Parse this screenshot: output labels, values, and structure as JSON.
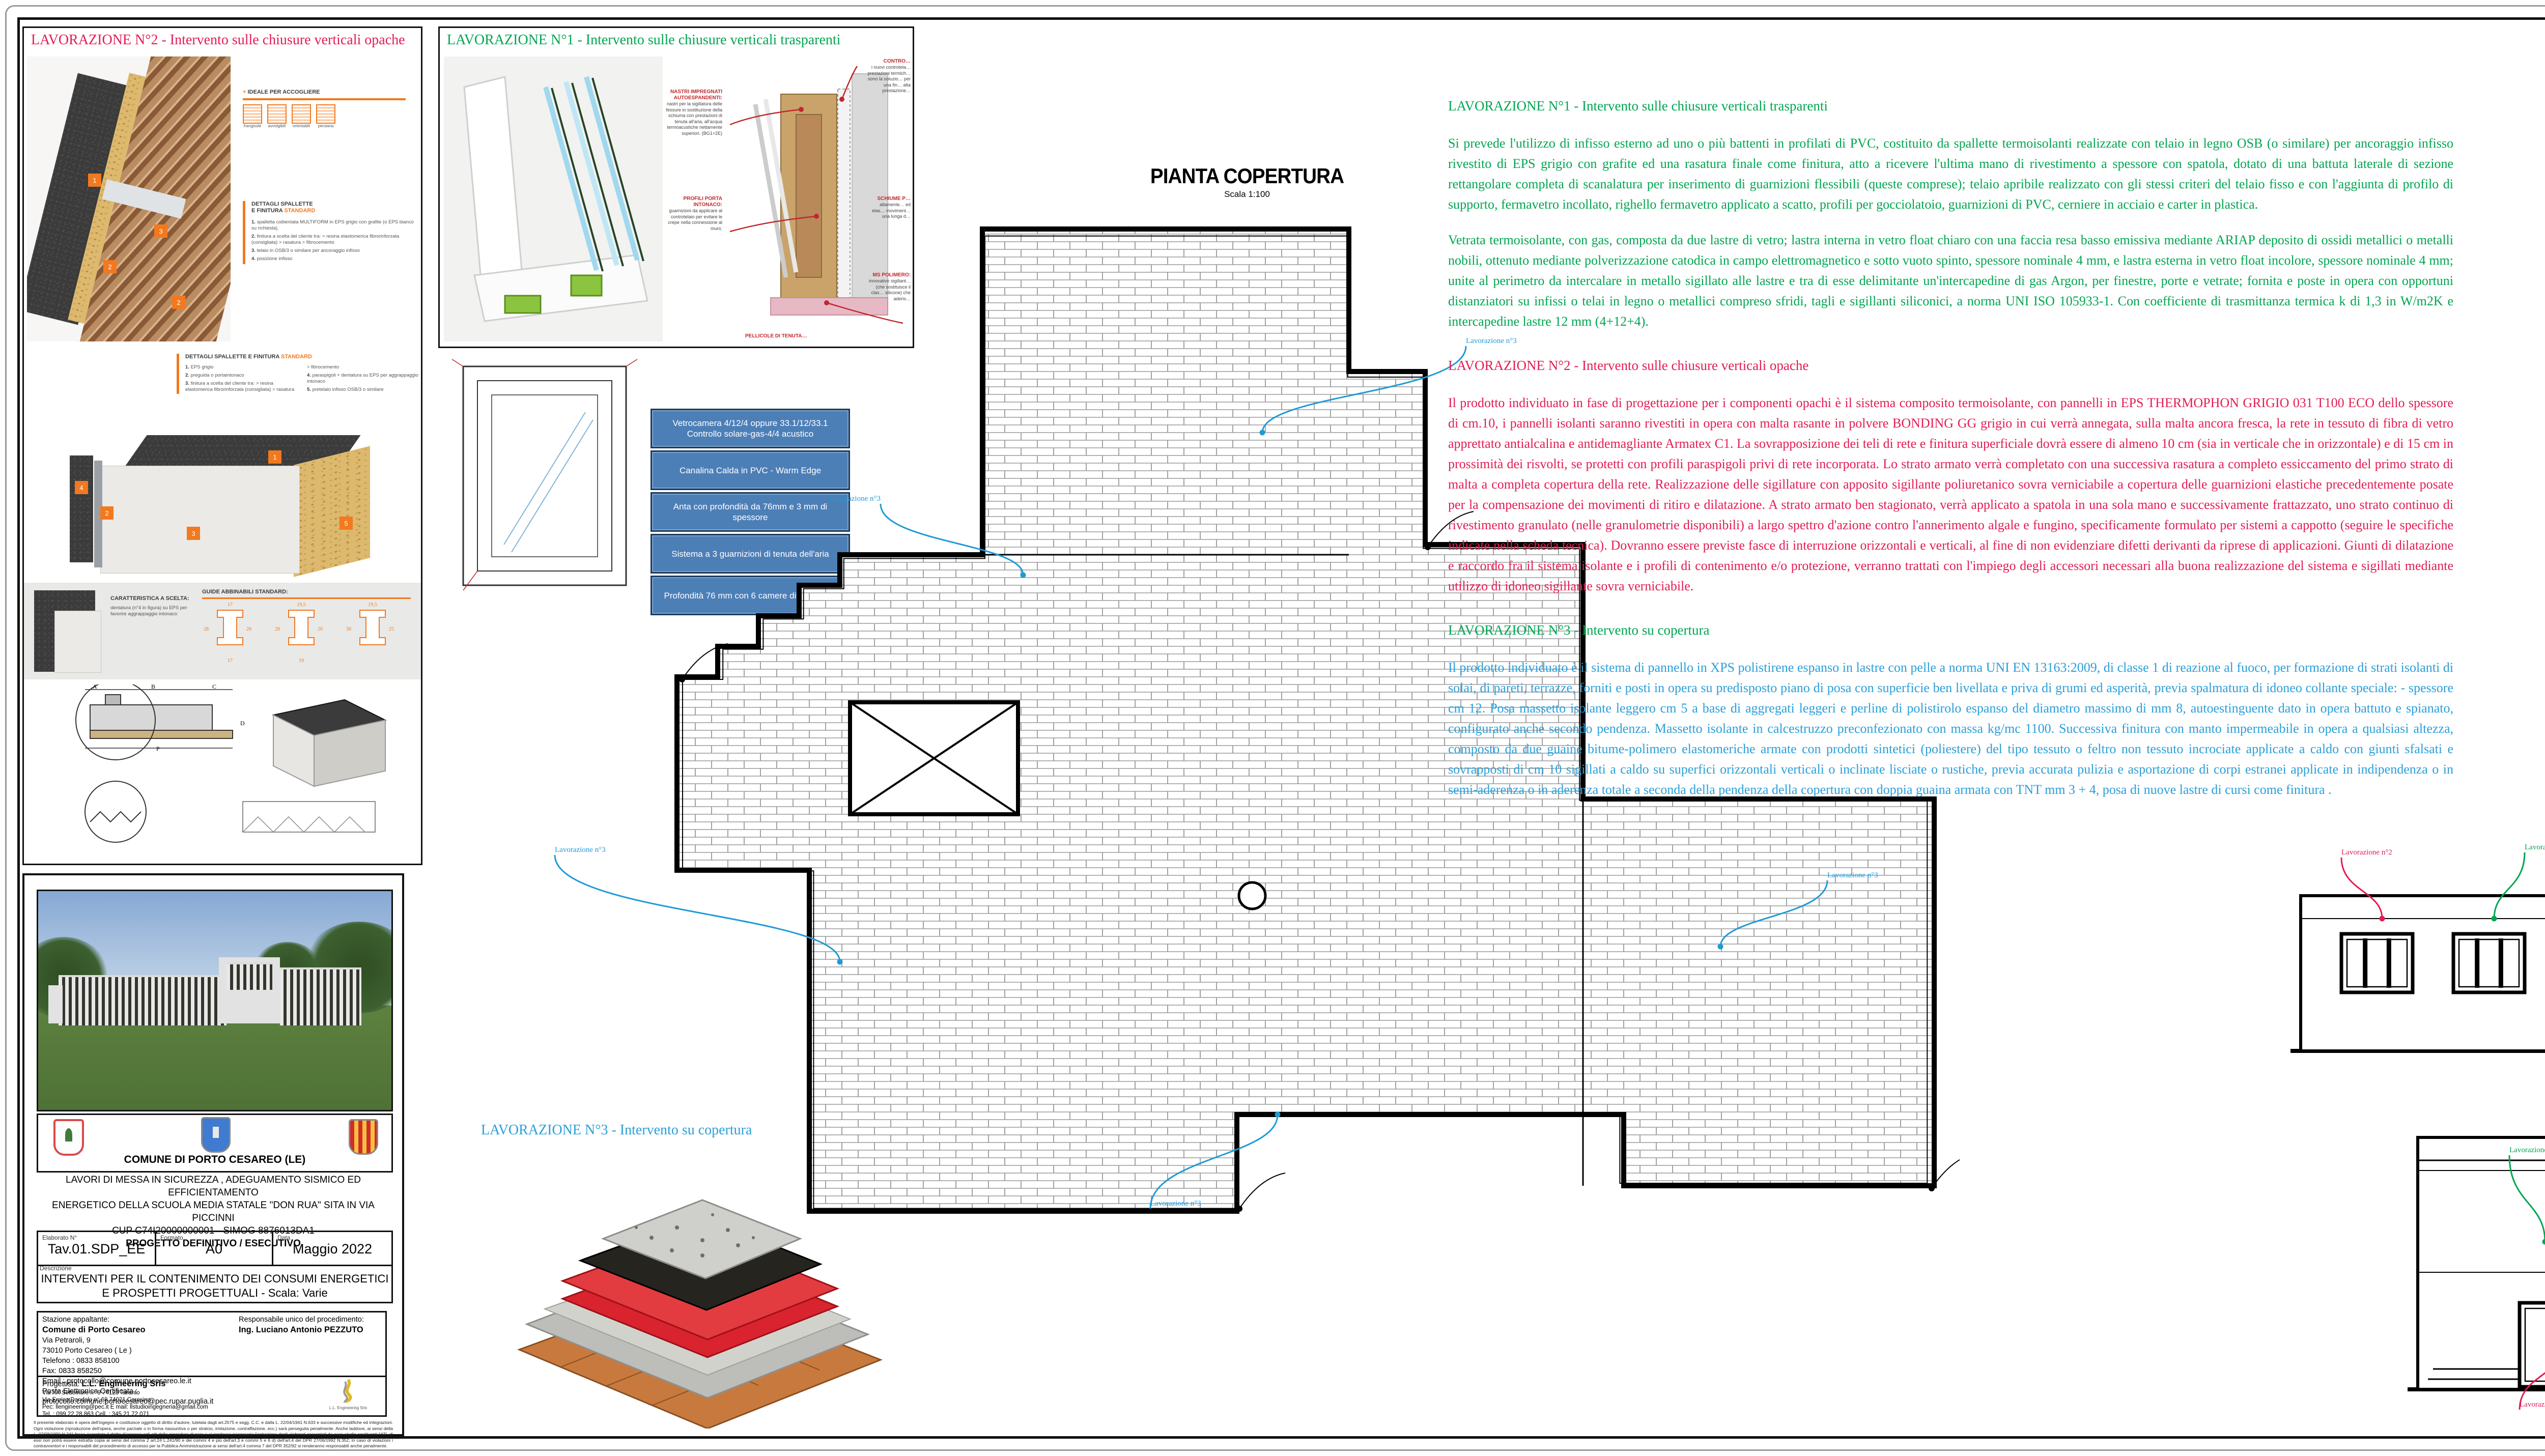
{
  "callouts": {
    "n1": {
      "label": "Lavorazione n°1",
      "color": "#00a651"
    },
    "n2": {
      "label": "Lavorazione n°2",
      "color": "#e31c54"
    },
    "n3": {
      "label": "Lavorazione n°3",
      "color": "#1f9ad7"
    }
  },
  "colors": {
    "green": "#00a651",
    "crimson": "#e31c54",
    "blue": "#2b9fd9",
    "orange": "#f2791f"
  },
  "panel2": {
    "title": "LAVORAZIONE N°2 - Intervento sulle chiusure verticali opache",
    "ideale_title": "IDEALE PER ACCOGLIERE",
    "ideale_items": [
      "frangisole",
      "avvolgibili",
      "orientabili",
      "persiana"
    ],
    "dettagli_title1": "DETTAGLI SPALLETTE",
    "dettagli_title2": "E FINITURA ",
    "dettagli_title_hl": "STANDARD",
    "dettagli1_items": [
      [
        "1.",
        "spalletta coibentata MULTIFORM in EPS grigio con grafite (o EPS bianco su richiesta)."
      ],
      [
        "2.",
        "finitura a scelta del cliente tra: > resina elastomerica fibrorinforzata (consigliata) > rasatura > fibrocemento"
      ],
      [
        "3.",
        "telaio in OSB/3 o similare per ancoraggio infisso"
      ],
      [
        "4.",
        "posizione infisso"
      ]
    ],
    "dettagli2_items": [
      [
        "1.",
        "EPS grigio"
      ],
      [
        "2.",
        "preguida o portaintonaco"
      ],
      [
        "3.",
        "finitura a scelta del cliente tra: > resina elastomerica fibrorinforzata (consigliata) > rasatura > fibrocemento"
      ],
      [
        "4.",
        "paraspigoli + dentatura su EPS per aggrappaggio intonaco"
      ],
      [
        "5.",
        "pretelaio infisso OSB/3 o similare"
      ]
    ],
    "caratteristica_title": "CARATTERISTICA A SCELTA:",
    "caratteristica_text": "dentatura (n°4 in figura) su EPS per favorire aggrappaggio intonaco",
    "guide_title1": "GUIDE",
    "guide_title2": "ABBINABILI STANDARD:",
    "guide_dims": [
      [
        "17",
        "28",
        "20",
        "17"
      ],
      [
        "19,5",
        "28",
        "20",
        "19"
      ],
      [
        "19,5",
        "30",
        "25"
      ]
    ],
    "section_letters": [
      "A",
      "B",
      "C",
      "D",
      "P"
    ]
  },
  "panel1": {
    "title": "LAVORAZIONE N°1 - Intervento sulle chiusure verticali trasparenti",
    "ann_nastri_title": "NASTRI IMPREGNATI AUTOESPANDENTI:",
    "ann_nastri_text": "nastri per la sigillatura delle fessure in sostituzione della schiuma con prestazioni di tenuta all'aria, all'acqua termoacustiche nettamente superiori. (BG1+2E)",
    "ann_profili_title": "PROFILI PORTA INTONACO:",
    "ann_profili_text": "guarnizioni da applicare al controtelaio per evitare le crepe nella connessione al muro.",
    "ann_contro_title": "CONTRO…",
    "ann_contro_text": "i nuovi controtela… prestazioni termich… sono la soluzio… per una fin… alta prestazione…",
    "ann_schiume_title": "SCHIUME P…",
    "ann_schiume_text": "altamente… ed elas… moviment… una lunga d…",
    "ann_ms_title": "MS POLIMERO:",
    "ann_ms_text": "innovativo sigillant… (che sostituisce il clas… silicone) che aderis…",
    "ann_pellicole_title": "PELLICOLE DI TENUTA…"
  },
  "glass_table": {
    "rows": [
      "Vetrocamera 4/12/4 oppure 33.1/12/33.1 Controllo solare-gas-4/4 acustico",
      "Canalina Calda in PVC - Warm Edge",
      "Anta con profondità da 76mm e 3 mm di spessore",
      "Sistema a 3 guarnizioni di tenuta dell'aria",
      "Profondità 76 mm con 6 camere differenziate"
    ]
  },
  "pianta": {
    "title": "PIANTA COPERTURA",
    "scale": "Scala 1:100"
  },
  "lav3_label": "LAVORAZIONE N°3 - Intervento su copertura",
  "specs": {
    "h1": "LAVORAZIONE N°1 - Intervento sulle chiusure verticali trasparenti",
    "p1a": "Si prevede l'utilizzo di infisso esterno ad uno o più battenti in profilati di PVC, costituito da spallette termoisolanti realizzate con telaio in legno OSB (o similare) per ancoraggio infisso rivestito di EPS grigio con grafite ed una rasatura finale come finitura,  atto a ricevere l'ultima mano di rivestimento a spessore con spatola, dotato di una battuta laterale di sezione rettangolare completa di scanalatura per inserimento di guarnizioni flessibili (queste comprese); telaio apribile realizzato con gli stessi criteri del telaio fisso e con l'aggiunta di profilo di supporto, fermavetro incollato, righello fermavetro applicato a scatto, profili per gocciolatoio, guarnizioni di PVC, cerniere in acciaio e carter in plastica.",
    "p1b": "Vetrata termoisolante, con gas, composta da due lastre di vetro; lastra interna in vetro float chiaro con una faccia resa basso emissiva mediante ARIAP deposito di ossidi metallici o metalli nobili, ottenuto mediante polverizzazione catodica in campo elettromagnetico e sotto vuoto spinto, spessore nominale 4 mm, e lastra esterna in vetro float incolore, spessore nominale 4 mm; unite al perimetro da intercalare in metallo sigillato alle lastre e tra di esse delimitante un'intercapedine di gas Argon, per finestre, porte e vetrate; fornita e poste in opera con opportuni distanziatori su infissi o telai in legno o metallici compreso sfridi, tagli e sigillanti siliconici, a norma UNI ISO 105933-1. Con coefficiente di trasmittanza termica k di 1,3 in W/m2K e intercapedine lastre 12 mm (4+12+4).",
    "h2": "LAVORAZIONE N°2 - Intervento sulle chiusure verticali opache",
    "p2": "Il prodotto individuato in fase di progettazione per i componenti opachi è il sistema composito termoisolante, con pannelli in EPS THERMOPHON GRIGIO 031 T100 ECO dello spessore di cm.10, i pannelli isolanti saranno rivestiti in opera con malta rasante in polvere BONDING GG grigio in cui verrà annegata, sulla malta ancora fresca, la rete in tessuto di fibra di vetro apprettato antialcalina e antidemagliante Armatex C1. La sovrapposizione dei teli di rete e finitura superficiale dovrà essere di almeno 10 cm (sia in verticale che in orizzontale) e di 15 cm in prossimità dei risvolti, se protetti con profili paraspigoli privi di rete incorporata. Lo strato armato verrà completato con una successiva rasatura a completo essiccamento del primo strato di malta a completa copertura della rete. Realizzazione delle sigillature con apposito sigillante poliuretanico sovra verniciabile a copertura delle guarnizioni elastiche precedentemente posate per la compensazione dei movimenti di ritiro e dilatazione. A strato armato ben stagionato, verrà applicato a spatola in una sola mano e successivamente frattazzato, uno strato continuo di rivestimento granulato (nelle granulometrie disponibili) a largo spettro d'azione contro l'annerimento algale e fungino, specificamente formulato per sistemi a cappotto (seguire le specifiche indicate nella scheda tecnica). Dovranno essere previste fasce di interruzione orizzontali e verticali, al fine di non evidenziare difetti derivanti da riprese di applicazioni. Giunti di dilatazione e raccordo fra il sistema isolante e i profili di contenimento e/o protezione, verranno trattati con l'impiego degli accessori necessari alla buona realizzazione del sistema e sigillati mediante utilizzo di idoneo sigillante sovra verniciabile.",
    "h3": "LAVORAZIONE N°3 - Intervento su copertura",
    "p3": "Il prodotto individuato è il sistema di pannello in XPS polistirene espanso in lastre  con pelle a norma UNI EN 13163:2009, di classe 1 di reazione al fuoco, per formazione di strati isolanti di solai, di pareti, terrazze, forniti e posti in opera su predisposto piano di posa con superficie ben livellata e priva di grumi ed asperità, previa spalmatura di idoneo collante speciale: - spessore cm 12. Posa massetto isolante leggero cm 5 a base di aggregati leggeri e perline di polistirolo espanso del diametro massimo di mm 8, autoestinguente dato in opera battuto e spianato, configurato anche secondo pendenza. Massetto isolante in calcestruzzo preconfezionato con massa kg/mc 1100.  Successiva finitura con manto impermeabile in opera a qualsiasi altezza, composto da due guaine bitume-polimero elastomeriche armate con prodotti sintetici (poliestere) del tipo tessuto o feltro non tessuto incrociate applicate a caldo con giunti sfalsati e sovrapposti di cm 10 sigillati a caldo su superfici orizzontali verticali o inclinate lisciate o rustiche, previa accurata pulizia e asportazione di corpi estranei applicate in indipendenza o in semi-aderenza o in aderenza totale a seconda della pendenza della copertura con doppia guaina armata con TNT mm 3 + 4, posa di nuove lastre di cursi come finitura ."
  },
  "elevations": [
    {
      "title": "PROSPETTO DX",
      "scale": "Scala 1:100"
    },
    {
      "title": "PROSPETTO SX",
      "scale": "Scala 1:100"
    },
    {
      "title": "PROSPETTO POSTERIORE",
      "scale": "Scala 1:100"
    },
    {
      "title": "PROSPETTO FRONTALE",
      "scale": "Scala 1:100"
    }
  ],
  "titleblock": {
    "comune": "COMUNE DI PORTO CESAREO (LE)",
    "project_line1": "LAVORI DI MESSA IN SICUREZZA , ADEGUAMENTO SISMICO ED EFFICIENTAMENTO",
    "project_line2": "ENERGETICO DELLA SCUOLA MEDIA STATALE \"DON RUA\" SITA IN VIA PICCINNI",
    "project_line3": "CUP C74I20000000001 -  SIMOG 8876013DA1",
    "project_line4": "PROGETTO DEFINITIVO / ESECUTIVO",
    "elaborato_label": "Elaborato N°",
    "elaborato": "Tav.01.SDP_EE",
    "formato_label": "Formato",
    "formato": "A0",
    "data_label": "Data",
    "data": "Maggio 2022",
    "descrizione_label": "Descrizione",
    "descrizione_line1": "INTERVENTI PER IL CONTENIMENTO DEI CONSUMI ENERGETICI",
    "descrizione_line2": "E PROSPETTI PROGETTUALI - Scala: Varie",
    "stazione_label": "Stazione appaltante:",
    "stazione_name": "Comune di Porto Cesareo",
    "stazione_lines": [
      "Via Petraroli, 9",
      "73010 Porto Cesareo ( Le )",
      "Telefono : 0833 858100",
      "Fax: 0833 858250",
      "Email : protocollo@comune.portocesareo.le.it",
      "Posta Elettronica Certificata :",
      "protocollo.comune.portocesareo@pec.rupar.puglia.it"
    ],
    "rup_label": "Responsabile unico del procedimento:",
    "rup_name": "Ing. Luciano Antonio PEZZUTO",
    "prog_label": "Progettista:",
    "prog_name": "L.L. Engineering Srls",
    "prog_lines": [
      "Via XX Settembre n° 9    74123 Taranto",
      "Via Enrico Dandolo n° 68    74021 Carosino",
      "Pec: llengineering@pec.it    E mail: llstudioingegneria@gmail.com",
      "Tel. : 099.22.28.863     Cell. : 345.21.72.071"
    ],
    "prog_logo_caption": "L.L. Engineering Srls",
    "disclaimer": "Il presente elaborato è opera dell'ingegno e costituisce oggetto di diritto d'autore, tutelata dagli art.2575 e segg. C.C. e dalla L. 22/04/1941 N.633 e successive modifiche ed integrazioni. Ogni violazione (riproduzione dell'opera, anche parziale o in forma riassuntiva o per stralcio, imitazione, contraffazione, ecc.) sarà perseguita penalmente. Anche laddove, ai sensi della L. 07/08/1990 N.241 fosse esercitato il diritto d'accesso agli atti della procedura di gara e si rendesse necessaria l'estrazione degli elaborati presentati da esso studio costituenti l'ATI, di essi non potrà essere estratta copia ai sensi del comma 2 art.24 L.241/90 e dei commi 4 e più dell'art.3 e commi 5 e 6 d) dell'art.4 del DPR 27/06/1992 N.352; in caso di violazioni i contravventori e i responsabili del procedimento di accesso per la Pubblica Amministrazione ai sensi dell'art.4 comma 7 del DPR 352/92 si renderanno responsabili anche penalmente."
  }
}
